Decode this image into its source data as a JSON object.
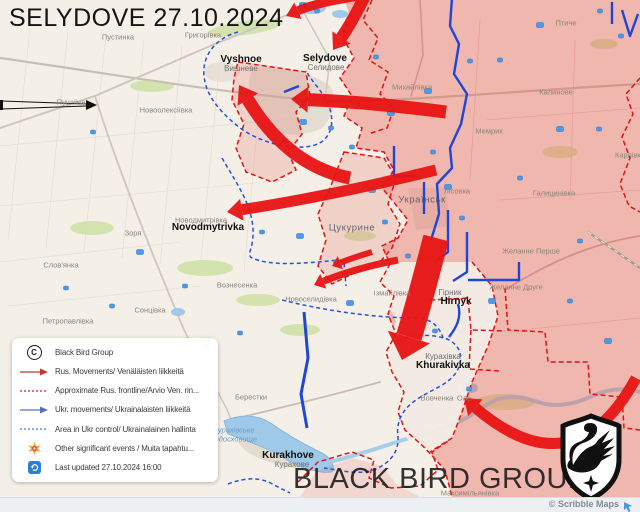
{
  "header": {
    "title": "SELYDOVE 27.10.2024"
  },
  "watermark": {
    "text": "BLACK BIRD GROUP"
  },
  "attribution": {
    "text": "© Scribble Maps"
  },
  "colors": {
    "russian_advance_red": "#e81414",
    "russian_area_pink": "#f2a49e",
    "ukrainian_blue": "#2b50d8",
    "frontline_red_dashed": "#e01414",
    "map_base": "#f4f0e8"
  },
  "legend": {
    "rows": [
      {
        "icon": "copyright-icon",
        "label": "Black Bird Group"
      },
      {
        "icon": "red-arrow-icon",
        "label": "Rus. Movements/ Venäläisten liikkeitä"
      },
      {
        "icon": "red-dashed-icon",
        "label": "Approximate Rus. frontline/Arvio Ven. rin..."
      },
      {
        "icon": "blue-arrow-icon",
        "label": "Ukr. movements/ Ukrainalaisten liikkeitä"
      },
      {
        "icon": "blue-dashed-icon",
        "label": "Area in Ukr control/ Ukrainalainen hallinta"
      },
      {
        "icon": "starburst-icon",
        "label": "Other significant events / Muita tapahtu..."
      },
      {
        "icon": "refresh-icon",
        "label": "Last updated 27.10.2024 16:00"
      }
    ]
  },
  "map": {
    "labels": [
      {
        "text": "Пустинка",
        "x": 118,
        "y": 37,
        "style": "minor"
      },
      {
        "text": "Григорівка",
        "x": 203,
        "y": 35,
        "style": "minor"
      },
      {
        "text": "Vyshnoe",
        "x": 241,
        "y": 60,
        "style": "en"
      },
      {
        "text": "Вишневе",
        "x": 241,
        "y": 69,
        "style": "ua"
      },
      {
        "text": "Selydove",
        "x": 325,
        "y": 59,
        "style": "en"
      },
      {
        "text": "Селидове",
        "x": 326,
        "y": 68,
        "style": "ua"
      },
      {
        "text": "Михайлівка",
        "x": 412,
        "y": 87,
        "style": "minor"
      },
      {
        "text": "Птиче",
        "x": 566,
        "y": 23,
        "style": "minor"
      },
      {
        "text": "Калинове",
        "x": 556,
        "y": 92,
        "style": "minor"
      },
      {
        "text": "Пушкіна",
        "x": 71,
        "y": 102,
        "style": "minor"
      },
      {
        "text": "Новоолексіївка",
        "x": 166,
        "y": 110,
        "style": "minor"
      },
      {
        "text": "Мемрик",
        "x": 489,
        "y": 131,
        "style": "minor"
      },
      {
        "text": "Карлівка",
        "x": 630,
        "y": 155,
        "style": "minor"
      },
      {
        "text": "Галицинівка",
        "x": 554,
        "y": 193,
        "style": "minor"
      },
      {
        "text": "Українськ",
        "x": 422,
        "y": 200,
        "style": "mid"
      },
      {
        "text": "Лісовка",
        "x": 457,
        "y": 191,
        "style": "minor"
      },
      {
        "text": "Зоря",
        "x": 133,
        "y": 233,
        "style": "minor"
      },
      {
        "text": "Цукурине",
        "x": 352,
        "y": 228,
        "style": "mid"
      },
      {
        "text": "Новодмитрівка",
        "x": 201,
        "y": 220,
        "style": "minor"
      },
      {
        "text": "Novodmytrivka",
        "x": 208,
        "y": 228,
        "style": "en"
      },
      {
        "text": "Желанне Перше",
        "x": 531,
        "y": 251,
        "style": "minor"
      },
      {
        "text": "Желанне Друге",
        "x": 516,
        "y": 287,
        "style": "minor"
      },
      {
        "text": "Вознесенка",
        "x": 237,
        "y": 285,
        "style": "minor"
      },
      {
        "text": "Новоселидівка",
        "x": 311,
        "y": 299,
        "style": "minor"
      },
      {
        "text": "Слов'янка",
        "x": 61,
        "y": 265,
        "style": "minor"
      },
      {
        "text": "Сонцівка",
        "x": 150,
        "y": 310,
        "style": "minor"
      },
      {
        "text": "Петропавлівка",
        "x": 68,
        "y": 321,
        "style": "minor"
      },
      {
        "text": "Ізмайлівка",
        "x": 392,
        "y": 293,
        "style": "minor"
      },
      {
        "text": "Гірник",
        "x": 450,
        "y": 293,
        "style": "ua"
      },
      {
        "text": "Hirnyk",
        "x": 456,
        "y": 302,
        "style": "en"
      },
      {
        "text": "Курахівка",
        "x": 443,
        "y": 357,
        "style": "ua"
      },
      {
        "text": "Khurakivka",
        "x": 443,
        "y": 366,
        "style": "en"
      },
      {
        "text": "Берестки",
        "x": 251,
        "y": 397,
        "style": "minor"
      },
      {
        "text": "Курахівське",
        "x": 234,
        "y": 430,
        "style": "water"
      },
      {
        "text": "водосховище",
        "x": 234,
        "y": 439,
        "style": "water"
      },
      {
        "text": "Kurakhove",
        "x": 288,
        "y": 456,
        "style": "en"
      },
      {
        "text": "Курахове",
        "x": 292,
        "y": 465,
        "style": "ua"
      },
      {
        "text": "Вовченка",
        "x": 437,
        "y": 398,
        "style": "minor"
      },
      {
        "text": "Оле",
        "x": 464,
        "y": 398,
        "style": "minor"
      },
      {
        "text": "Максимільянівка",
        "x": 470,
        "y": 493,
        "style": "minor"
      }
    ]
  }
}
